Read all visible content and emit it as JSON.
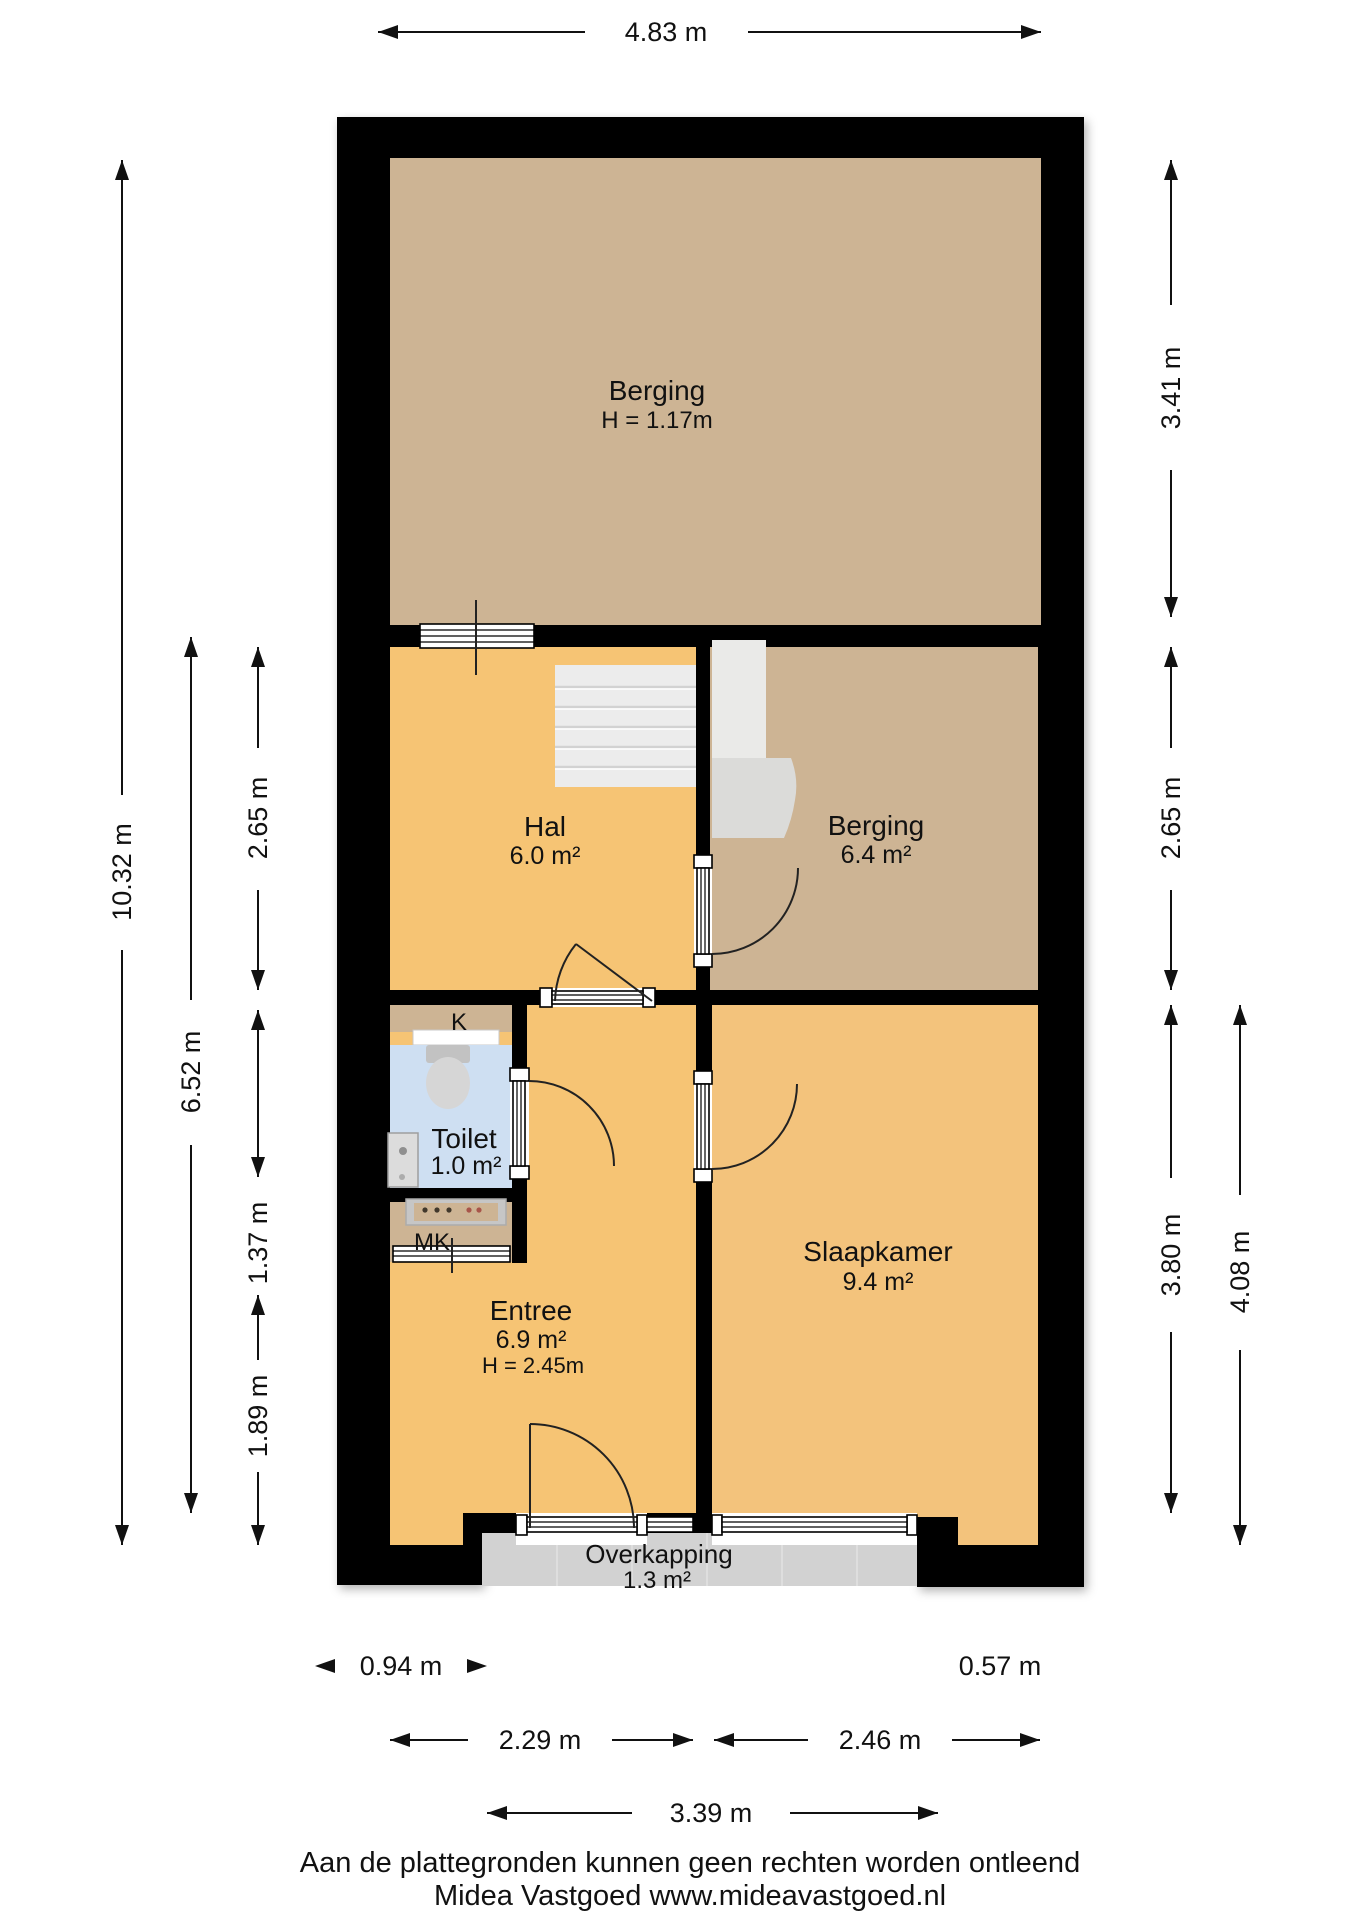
{
  "title": "Floor plan (plattegrond) souterrain/begane grond",
  "rooms": {
    "berging_top": {
      "name": "Berging",
      "height": "H = 1.17m"
    },
    "hal": {
      "name": "Hal",
      "area": "6.0 m²"
    },
    "berging": {
      "name": "Berging",
      "area": "6.4 m²"
    },
    "toilet": {
      "name": "Toilet",
      "area": "1.0 m²"
    },
    "kast": {
      "label": "K"
    },
    "meterkast": {
      "label": "MK"
    },
    "entree": {
      "name": "Entree",
      "area": "6.9 m²",
      "height": "H = 2.45m"
    },
    "slaapkamer": {
      "name": "Slaapkamer",
      "area": "9.4 m²"
    },
    "overkapping": {
      "name": "Overkapping",
      "area": "1.3 m²"
    }
  },
  "dimensions": {
    "top_width": "4.83 m",
    "left_total": "10.32 m",
    "left_mid": "6.52 m",
    "left_hal": "2.65 m",
    "left_toilet": "1.37 m",
    "left_entree": "1.89 m",
    "right_berging_top": "3.41 m",
    "right_berging": "2.65 m",
    "right_slaapkamer": "3.80 m",
    "right_slaapkamer_outer": "4.08 m",
    "bottom_step": "0.94 m",
    "bottom_bulge": "0.57 m",
    "bottom_entree": "2.29 m",
    "bottom_slaapkamer": "2.46 m",
    "bottom_overkapping": "3.39 m"
  },
  "footer": {
    "line1": "Aan de plattegronden kunnen geen rechten worden ontleend",
    "line2": "Midea Vastgoed www.mideavastgoed.nl"
  },
  "colors": {
    "wall": "#000000",
    "storage_tan": "#CDB494",
    "living_orange": "#F6C474",
    "bedroom_orange": "#F3C37C",
    "toilet_blue": "#CEDFF2",
    "overkapping_grey": "#D2D2D2",
    "stairs_grey": "#ECECEC",
    "fixture_grey": "#D6D6D6"
  }
}
